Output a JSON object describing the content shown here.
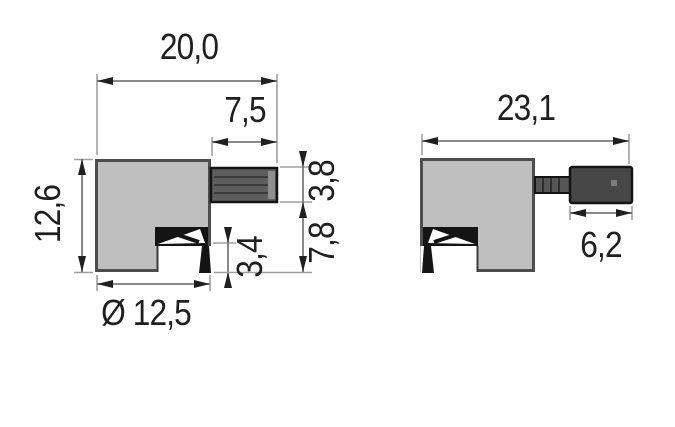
{
  "diagram": {
    "kind": "technical dimension drawing, two side views of a small component",
    "left_view": {
      "dims": {
        "total_width": "20,0",
        "shaft_length": "7,5",
        "body_height": "12,6",
        "diameter": "Ø 12,5",
        "notch_height": "3,4",
        "shaft_diameter": "3,8",
        "shaft_to_base": "7,8"
      }
    },
    "right_view": {
      "dims": {
        "total_width": "23,1",
        "knob_length": "6,2"
      }
    },
    "colors": {
      "background": "#ffffff",
      "body_fill": "#bfbfbf",
      "body_stroke": "#4d4d4d",
      "shaft_fill": "#5e5e5e",
      "knob_fill": "#474747",
      "dimension_line": "#7a7a7a",
      "extension_line": "#a0a0a0",
      "arrow_and_text": "#1f1f1f"
    }
  }
}
